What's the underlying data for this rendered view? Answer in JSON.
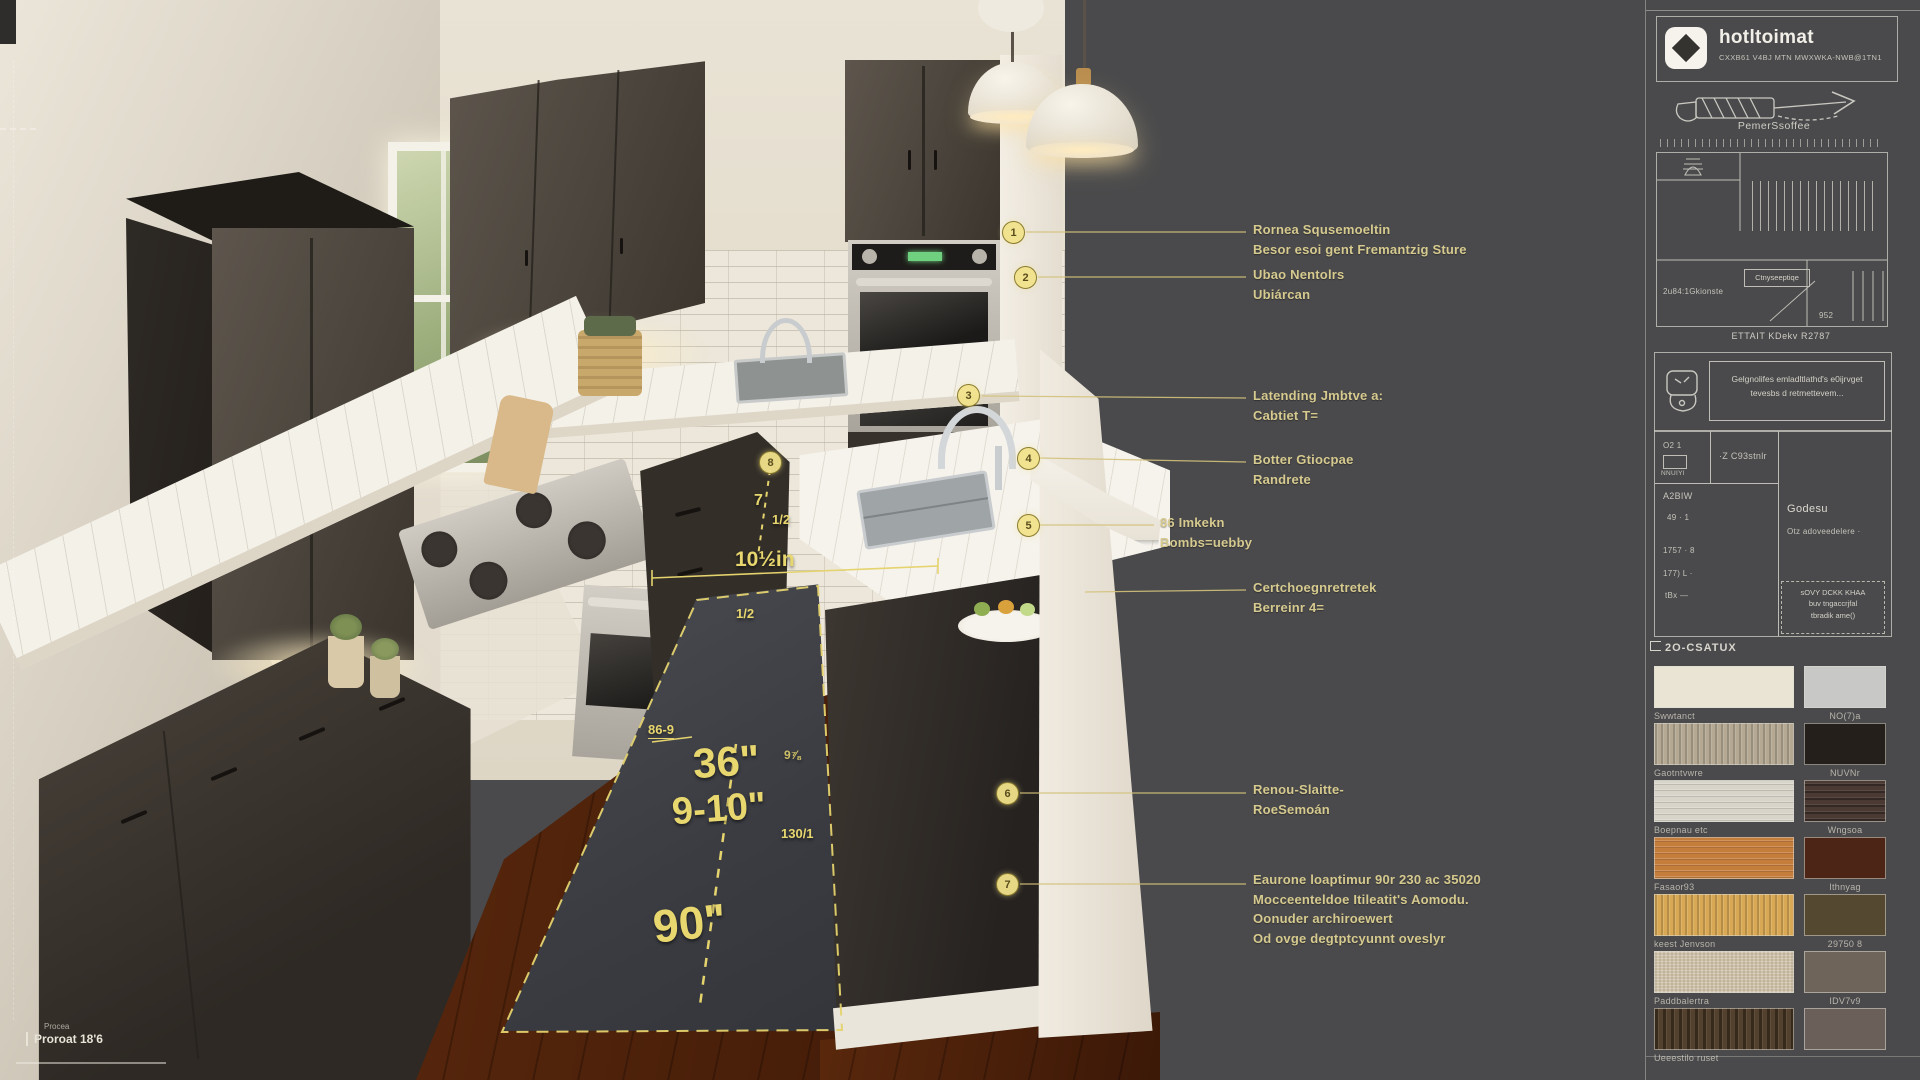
{
  "scene": {
    "measurements": {
      "rug_width": "36\"",
      "rug_gap": "9-10\"",
      "rug_length": "90\"",
      "clearance": "10½in",
      "clearance_whole": "7",
      "clearance_frac": "1/2",
      "frac_small": "1/2",
      "tick_left": "86-9",
      "tick_mid": "130/1",
      "tick_island": "9⅞",
      "floor_note_small": "Procea",
      "floor_note": "Proroat 18'6"
    }
  },
  "annotations": {
    "markers": [
      "1",
      "2",
      "3",
      "4",
      "5",
      "6",
      "7",
      "8"
    ],
    "labels": [
      {
        "lines": [
          "Rornea Squsemoeltin",
          "Besor esoi gent Fremantzig Sture"
        ]
      },
      {
        "lines": [
          "Ubao Nentolrs",
          "Ubiárcan"
        ]
      },
      {
        "lines": [
          "Latending Jmbtve a:",
          "Cabtiet T="
        ]
      },
      {
        "lines": [
          "Botter Gtiocpae",
          "Randrete"
        ]
      },
      {
        "lines": [
          "86 Imkekn",
          "Bombs=uebby"
        ]
      },
      {
        "lines": [
          "Certchoegnretretek",
          "Berreinr 4="
        ]
      },
      {
        "lines": [
          "Renou-Slaitte-",
          "RoeSemoán"
        ]
      },
      {
        "lines": [
          "Eaurone loaptimur 90r 230 ac 35020",
          "Mocceenteldoe Itileatit's Aomodu.",
          "Oonuder archiroewert",
          "Od ovge degtptcyunnt oveslyr"
        ]
      }
    ]
  },
  "panel": {
    "logo": {
      "name": "hotltoimat",
      "tagline": "CXXB61 V4BJ MTN MWXWKA-NWB@1TN1"
    },
    "tape_label": "PemerSsoffee",
    "plan": {
      "box_label": "Ctnyseeptiqe",
      "left_label": "2u84:1Gkionste",
      "dim": "952",
      "caption": "ETTAIT KDekv R2787"
    },
    "spec": {
      "note_line1": "Gelgnolifes emladltlathd's e0ijrvget",
      "note_line2": "tevesbs d retmettevem...",
      "cell_a": "O2 1",
      "cell_a2": "NNUIYI",
      "cell_b": "·Z C93stnlr",
      "row_1": "A2BIW",
      "row_2": "49 · 1",
      "row_3": "1757 · 8",
      "row_4": "177) L ·",
      "row_5": "tBx —",
      "head": "Godesu",
      "body": "Otz adoveedelere ·",
      "note_box": [
        "sOVY DCKK KHAA",
        "buv tngaccrjfal",
        "tbradik ame()"
      ]
    },
    "section_label": "2O-CSATUX",
    "swatches": [
      {
        "label": "Swwtanct",
        "color": "#eae4d4"
      },
      {
        "label": "NO(7)a",
        "color": "#c8c8c6"
      },
      {
        "label": "Gaotntvwre",
        "color": "#b5a994"
      },
      {
        "label": "NUVNr",
        "color": "#241f1b"
      },
      {
        "label": "Boepnau etc",
        "color": "#d8d4ca"
      },
      {
        "label": "Wngsoa",
        "color": "#4a3a33"
      },
      {
        "label": "Fasaor93",
        "color": "#c57d3c"
      },
      {
        "label": "Ithnyag",
        "color": "#4c2517"
      },
      {
        "label": "keest Jenvson",
        "color": "#d9a855"
      },
      {
        "label": "29750 8",
        "color": "#544830"
      },
      {
        "label": "Paddbalertra",
        "color": "#cfc2a9"
      },
      {
        "label": "IDV7v9",
        "color": "#6f6459"
      },
      {
        "label": "Ueeestilo ruset",
        "color": "#53402d"
      },
      {
        "label": "",
        "color": "#6b6059"
      }
    ]
  },
  "colors": {
    "accent_yellow": "#e5d36e",
    "panel_bg": "#4a4a4c",
    "leader_line": "#d3c27b"
  }
}
